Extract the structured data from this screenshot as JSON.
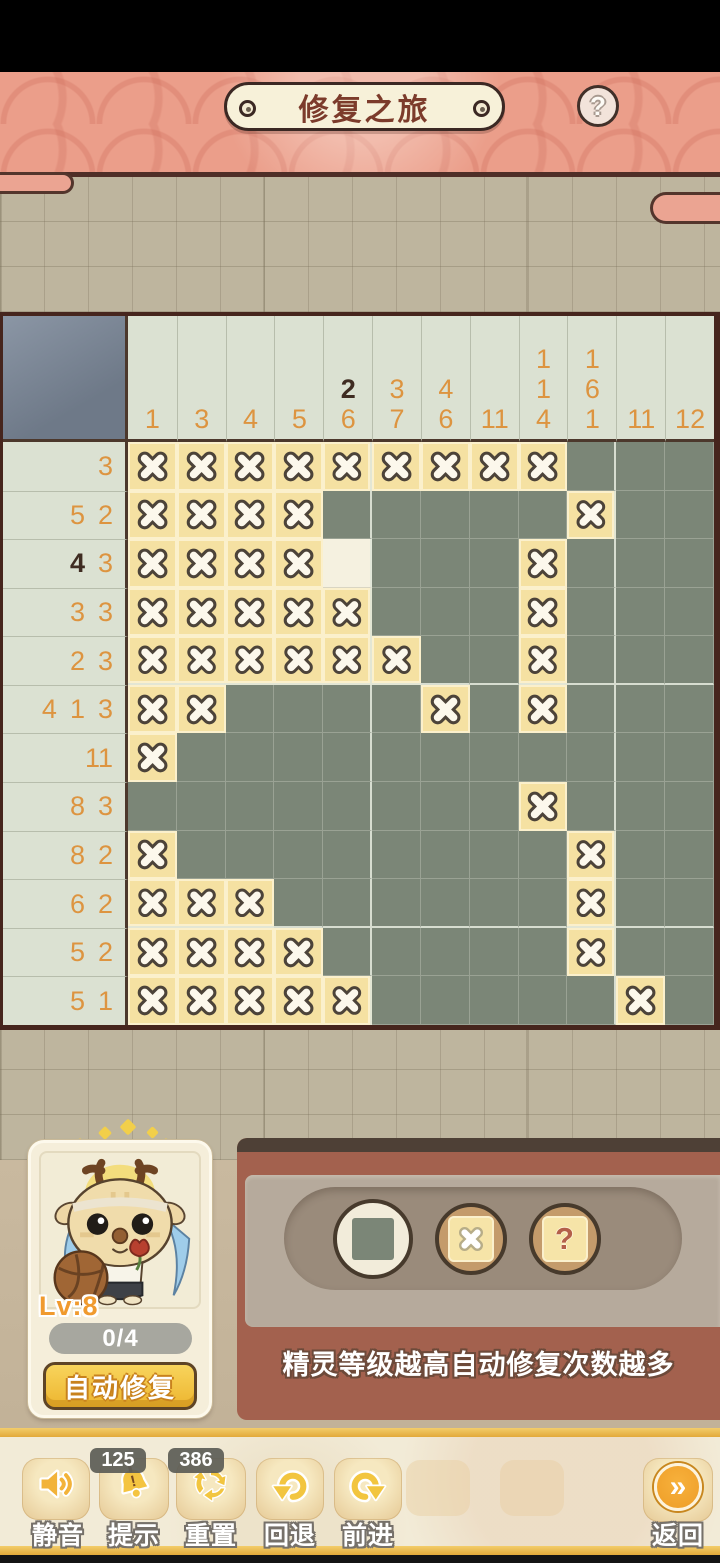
{
  "header": {
    "title": "修复之旅",
    "help_glyph": "?"
  },
  "board": {
    "column_hints": [
      [
        "1"
      ],
      [
        "3"
      ],
      [
        "4"
      ],
      [
        "5"
      ],
      [
        "!2",
        "6"
      ],
      [
        "3",
        "7"
      ],
      [
        "4",
        "6"
      ],
      [
        "11"
      ],
      [
        "1",
        "1",
        "4"
      ],
      [
        "1",
        "6",
        "1"
      ],
      [
        "11"
      ],
      [
        "12"
      ]
    ],
    "row_hints": [
      [
        "3"
      ],
      [
        "5",
        "2"
      ],
      [
        "!4",
        "3"
      ],
      [
        "3",
        "3"
      ],
      [
        "2",
        "3"
      ],
      [
        "4",
        "1",
        "3"
      ],
      [
        "11"
      ],
      [
        "8",
        "3"
      ],
      [
        "8",
        "2"
      ],
      [
        "6",
        "2"
      ],
      [
        "5",
        "2"
      ],
      [
        "5",
        "1"
      ]
    ],
    "cells": [
      "xxxxxxxxxfff",
      "xxxxfffffxff",
      "xxxxufffxfff",
      "xxxxxfffxfff",
      "xxxxxxffxfff",
      "xxffffxfxfff",
      "xfffffffffff",
      "ffffffffxfff",
      "xffffffffxff",
      "xxxffffffxff",
      "xxxxfffffxff",
      "xxxxxfffffxf"
    ],
    "legend": {
      "f": "filled",
      "x": "marked-empty",
      "u": "unknown",
      "!": "hint-unsatisfied-dark"
    },
    "colors": {
      "filled": "#7b8677",
      "mark_bg": "#f5e1a2",
      "unknown_bg": "#f5f1e0",
      "hint_orange": "#dd9440",
      "hint_dark": "#3f2c22"
    }
  },
  "pet_card": {
    "level": "Lv:8",
    "counter": "0/4",
    "auto_repair_label": "自动修复"
  },
  "tool_panel": {
    "tip": "精灵等级越高自动修复次数越多",
    "unknown_glyph": "?",
    "tools": [
      {
        "id": "fill",
        "selected": true
      },
      {
        "id": "mark-x",
        "selected": false
      },
      {
        "id": "mark-unknown",
        "selected": false
      }
    ]
  },
  "toolbar": {
    "buttons": [
      {
        "id": "mute",
        "label": "静音"
      },
      {
        "id": "hint",
        "label": "提示",
        "badge": "125"
      },
      {
        "id": "reset",
        "label": "重置",
        "badge": "386"
      },
      {
        "id": "undo",
        "label": "回退"
      },
      {
        "id": "redo",
        "label": "前进"
      },
      {
        "id": "back",
        "label": "返回",
        "glyph": "»"
      }
    ]
  }
}
